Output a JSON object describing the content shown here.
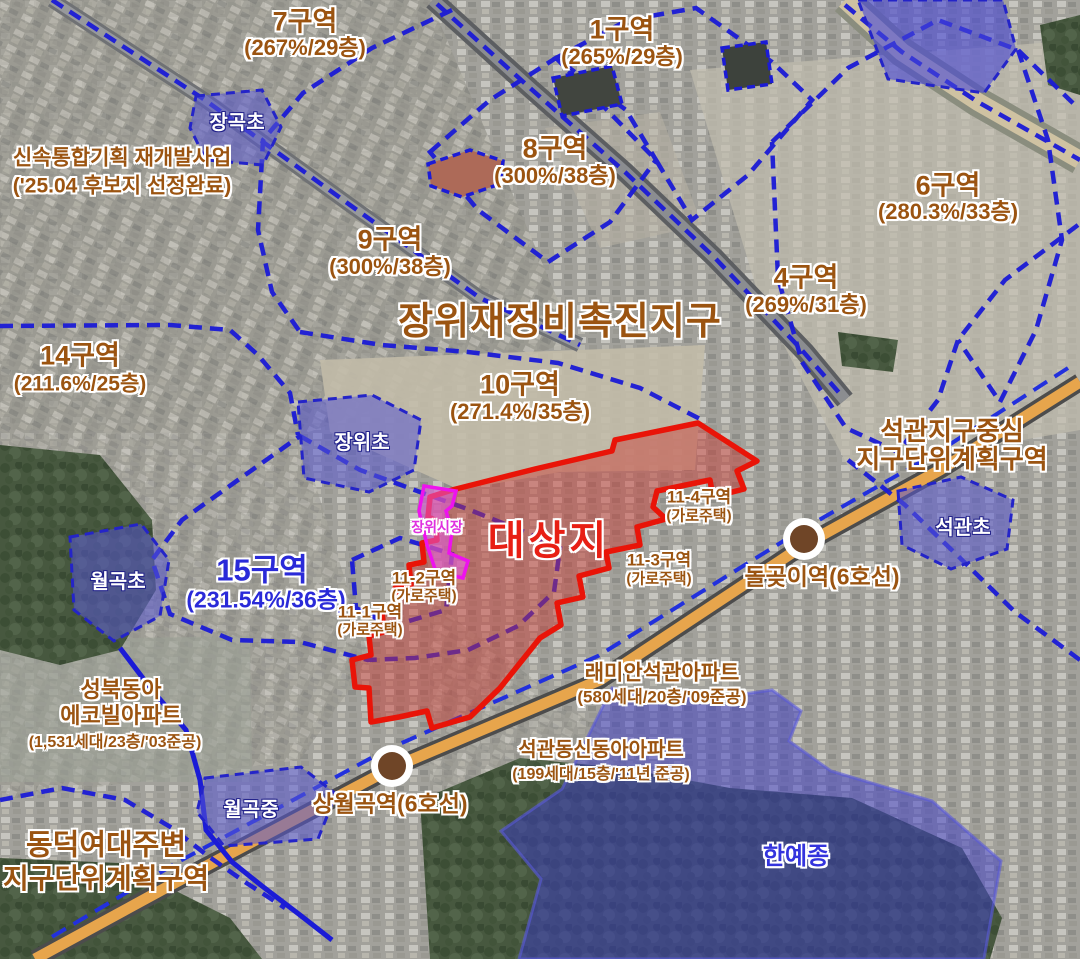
{
  "title": {
    "text": "장위재정비촉진지구"
  },
  "notes": {
    "fast_track": {
      "line1": "신속통합기획 재개발사업",
      "line2": "('25.04 후보지 선정완료)"
    }
  },
  "zones": {
    "z7": {
      "name": "7구역",
      "spec": "(267%/29층)"
    },
    "z1": {
      "name": "1구역",
      "spec": "(265%/29층)"
    },
    "z8": {
      "name": "8구역",
      "spec": "(300%/38층)"
    },
    "z6": {
      "name": "6구역",
      "spec": "(280.3%/33층)"
    },
    "z9": {
      "name": "9구역",
      "spec": "(300%/38층)"
    },
    "z4": {
      "name": "4구역",
      "spec": "(269%/31층)"
    },
    "z14": {
      "name": "14구역",
      "spec": "(211.6%/25층)"
    },
    "z10": {
      "name": "10구역",
      "spec": "(271.4%/35층)"
    },
    "z15": {
      "name": "15구역",
      "spec": "(231.54%/36층)"
    }
  },
  "target_site": {
    "label": "대상지"
  },
  "market": {
    "label": "장위시장"
  },
  "street_housing": {
    "s11_1": {
      "name": "11-1구역",
      "type": "(가로주택)"
    },
    "s11_2": {
      "name": "11-2구역",
      "type": "(가로주택)"
    },
    "s11_3": {
      "name": "11-3구역",
      "type": "(가로주택)"
    },
    "s11_4": {
      "name": "11-4구역",
      "type": "(가로주택)"
    }
  },
  "schools": {
    "janggok": "장곡초",
    "jangwi": "장위초",
    "wolgok_elem": "월곡초",
    "seokgwan_elem": "석관초",
    "wolgok_mid": "월곡중",
    "hanyejong": "한예종"
  },
  "stations": {
    "dolgoji": "돌곶이역(6호선)",
    "sangwolgok": "상월곡역(6호선)"
  },
  "apartments": {
    "raemian": {
      "name": "래미안석관아파트",
      "spec": "(580세대/20층/'09준공)"
    },
    "shindonga": {
      "name": "석관동신동아아파트",
      "spec": "(199세대/15층/'11년 준공)"
    },
    "seongbuk_donga": {
      "name": "성북동아",
      "name2": "에코빌아파트",
      "spec": "(1,531세대/23층/'03준공)"
    }
  },
  "plan_districts": {
    "seokgwan": {
      "line1": "석관지구중심",
      "line2": "지구단위계획구역"
    },
    "dongduk": {
      "line1": "동덕여대주변",
      "line2": "지구단위계획구역"
    }
  },
  "colors": {
    "zone_label_brown": "#9b5411",
    "boundary_blue": "#1b1bd6",
    "zone15_blue": "#2a2ad8",
    "target_red": "#e81f14",
    "market_magenta": "#df30df",
    "school_overlay_blue": "#4747cc",
    "station_brown": "#6f4527",
    "road_orange": "#e7a54c"
  }
}
